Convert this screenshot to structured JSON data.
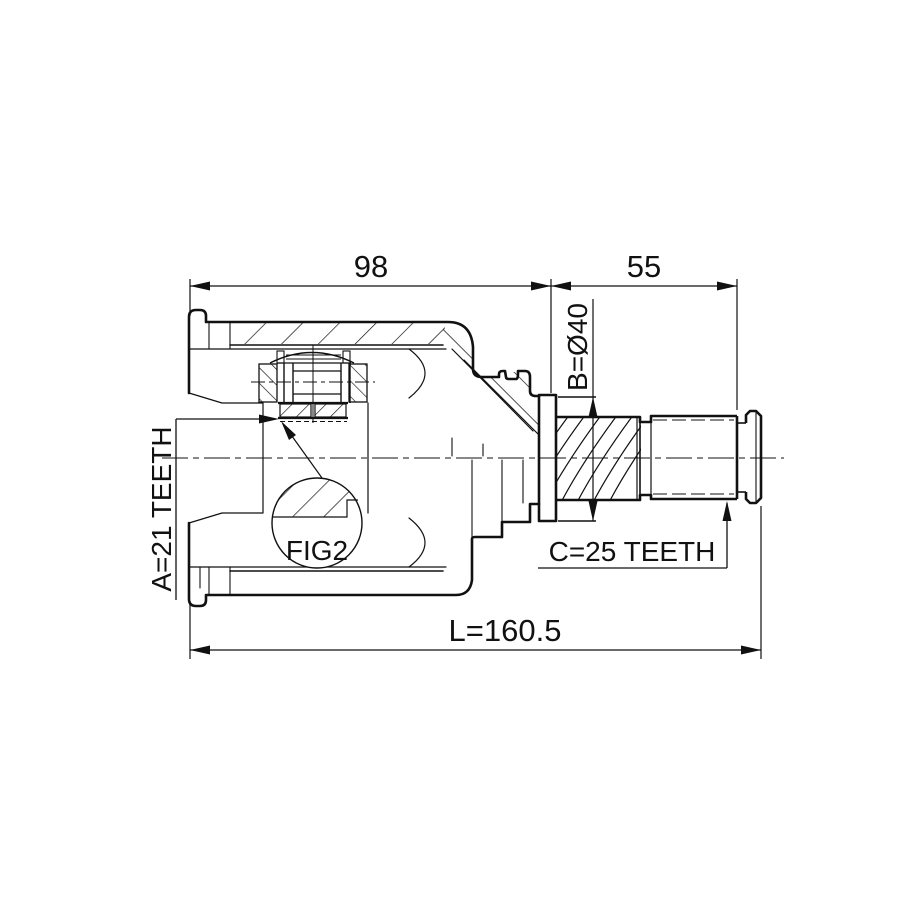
{
  "colors": {
    "background": "#ffffff",
    "line": "#111111"
  },
  "drawing": {
    "dim_housing_length": "98",
    "dim_shaft_length": "55",
    "dim_flange_diameter": "B=Ø40",
    "dim_inner_spline_teeth": "A=21 TEETH",
    "dim_outer_spline_teeth": "C=25 TEETH",
    "dim_overall_length": "L=160.5",
    "detail_callout": "FIG2"
  }
}
